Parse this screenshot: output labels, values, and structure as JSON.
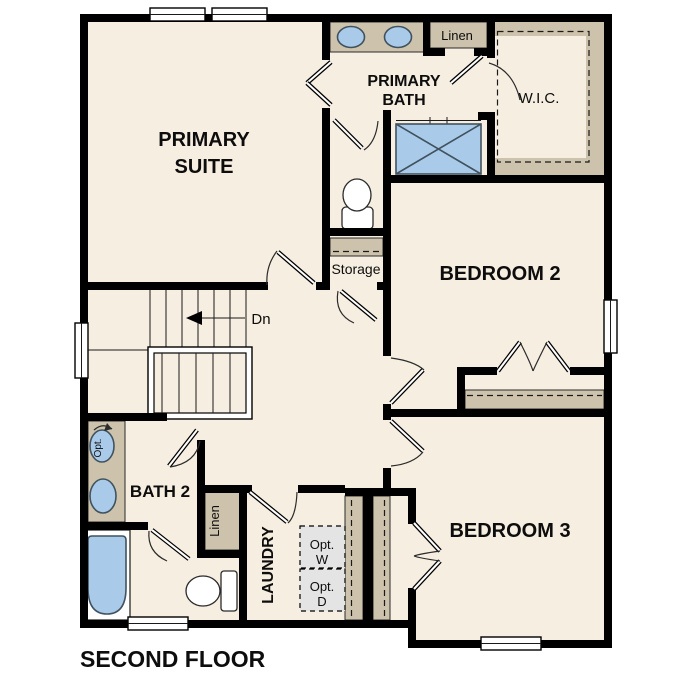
{
  "plan": {
    "title": "SECOND FLOOR",
    "rooms": {
      "primary_suite": {
        "line1": "PRIMARY",
        "line2": "SUITE"
      },
      "primary_bath": {
        "line1": "PRIMARY",
        "line2": "BATH"
      },
      "wic": {
        "label": "W.I.C."
      },
      "bedroom_2": {
        "label": "BEDROOM 2"
      },
      "bedroom_3": {
        "label": "BEDROOM 3"
      },
      "bath_2": {
        "label": "BATH 2"
      },
      "laundry": {
        "label": "LAUNDRY"
      },
      "storage": {
        "label": "Storage"
      },
      "linen_upper": {
        "label": "Linen"
      },
      "linen_lower": {
        "label": "Linen"
      }
    },
    "annotations": {
      "stairs_direction": "Dn",
      "optional_sink": "Opt.",
      "optional_washer_line1": "Opt.",
      "optional_washer_line2": "W",
      "optional_dryer_line1": "Opt.",
      "optional_dryer_line2": "D"
    },
    "colors": {
      "wall": "#000000",
      "floor": "#f6eee0",
      "casework": "#cdc2ab",
      "fixture_fill": "#a9cbe9",
      "fixture_stroke": "#41525f",
      "optional_appliance_fill": "#e4e4e4",
      "background": "#ffffff"
    }
  }
}
